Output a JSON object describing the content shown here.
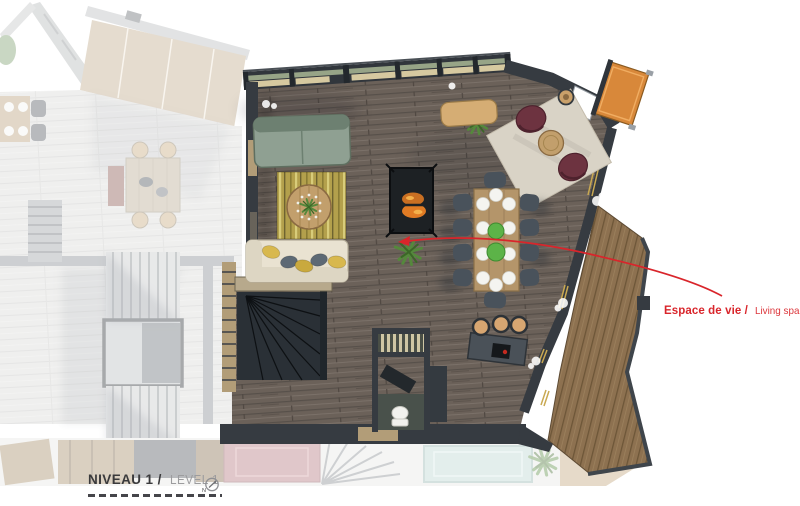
{
  "annotation": {
    "label_primary": "Espace de vie /",
    "label_secondary": "Living space"
  },
  "footer": {
    "level_primary": "NIVEAU 1 /",
    "level_secondary": "LEVEL 1",
    "north_letter": "N"
  },
  "palette": {
    "accent": "#d9252b",
    "wall-dark": "#363b41",
    "wall-mid": "#4a5158",
    "wall-outline": "#1e2226",
    "floor-wood": "#6b6159",
    "deck-wood": "#8d7150",
    "deck-orange": "#d8883a",
    "sofa-green": "#8fa092",
    "sofa-green-dark": "#6d8071",
    "sofa-cream": "#e9e2d1",
    "sofa-cream-dark": "#ddd6c3",
    "rug-yellow": "#b3a04c",
    "rug-beige": "#d9d3c6",
    "chair-burgundy": "#6d3340",
    "wood-table": "#c29f6c",
    "dining-wood": "#b4956a",
    "chair-dark": "#49525b",
    "stool-tan": "#d7a671",
    "fire-orange": "#e07b24",
    "plant-green": "#55883c",
    "plate-green": "#5cb348",
    "glass-sill": "#d6c9a0",
    "glass-green": "#97a487",
    "window-gold": "#c9a952",
    "stair-dark": "#2a3036",
    "wc-floor": "#49514b",
    "faded-floor": "#d8d8d6",
    "faded-wall": "#888d93",
    "faded-wood": "#c0ab8c",
    "pool-blue": "#bcd7d1",
    "text-dark": "#3a3a3c",
    "text-light": "#9c9c9e"
  },
  "plan": {
    "features": [
      "north-window-band",
      "green-sofa",
      "yellow-rug",
      "round-coffee-table",
      "corner-sofa-cream",
      "fireplace",
      "plant-tuft",
      "window-bench",
      "reading-rug",
      "burgundy-armchairs",
      "side-table",
      "dining-table-ten-seats",
      "kitchen-island",
      "bar-stools",
      "wc-room",
      "toilet",
      "winder-staircase",
      "terrace-deck",
      "orange-balcony-panel",
      "neighbor-unit-faded",
      "pool-faded"
    ]
  }
}
